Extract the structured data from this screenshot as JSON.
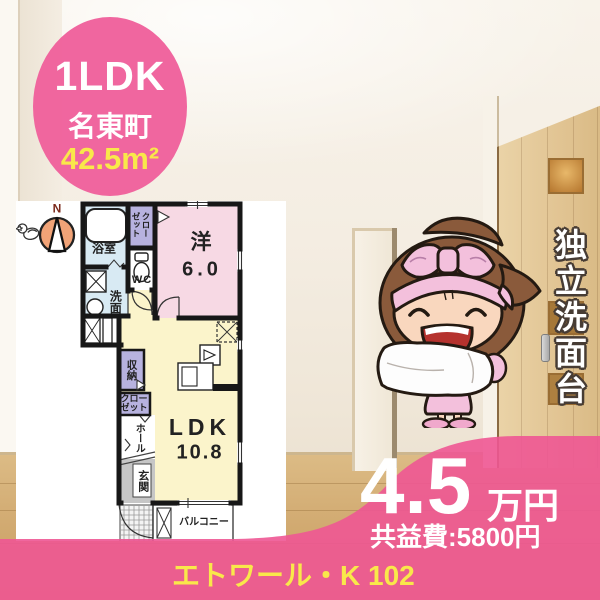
{
  "badge": {
    "layout": "1LDK",
    "location": "名東町",
    "area": "42.5m²"
  },
  "floorplan": {
    "compass_label": "N",
    "rooms": {
      "bath": "浴室",
      "closet_top": "クローゼット",
      "wc": "WC",
      "washroom": "洗面",
      "western_label": "洋",
      "western_size": "6.0",
      "storage": "収納",
      "closet_lower": "クローゼット",
      "hall": "ホール",
      "entrance": "玄関",
      "ldk_label": "LDK",
      "ldk_size": "10.8",
      "balcony": "バルコニー"
    }
  },
  "feature": {
    "vertical_text": "独立洗面台"
  },
  "price": {
    "rent": "4.5",
    "unit": "万円",
    "fee": "共益費:5800円"
  },
  "property": {
    "name": "エトワール・K 102"
  },
  "colors": {
    "accent_pink": "#ee5a95",
    "accent_yellow": "#f9e84a",
    "room_pink": "#f7d9e4",
    "room_yellow": "#fbf4cb",
    "room_blue": "#d8eaf3",
    "room_lavender": "#b7b2df",
    "entrance_gray": "#c6c6c6",
    "compass_orange": "#f1a377",
    "wall_black": "#171717"
  }
}
